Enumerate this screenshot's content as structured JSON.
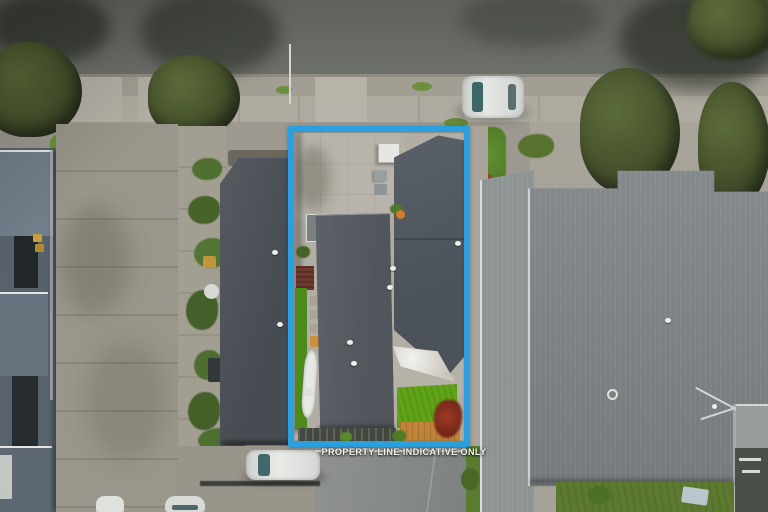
{
  "overlay": {
    "watermark": "PROPERTY LINE INDICATIVE ONLY",
    "property_line_color": "#2aa0df"
  },
  "scene": {
    "type": "aerial-drone-photo",
    "subject": "suburban house lot outlined by blue property-line box",
    "visible_objects": [
      "street at top with tree shadows",
      "footpath and driveway crossings",
      "silver car parked on street",
      "street light pole",
      "apartment building at left with yellow bins",
      "shared concrete driveway on left",
      "left neighbour dark gable roof",
      "subject lot: concrete courtyard, two dark corrugated roofs, artificial lawn, timber deck, red maple, white kayak",
      "right neighbour large grey roof with ring vent and TV antenna",
      "white car parked in front driveway",
      "two car noses at bottom-left",
      "garage roof at bottom centre"
    ],
    "palette": {
      "road": "#686b66",
      "concrete": "#a7a399",
      "roof_dark": "#545a62",
      "roof_light": "#7d8183",
      "lawn": "#5fa517",
      "deck": "#c08438",
      "tree_canopy": "#46522c",
      "property_line": "#2aa0df"
    }
  }
}
